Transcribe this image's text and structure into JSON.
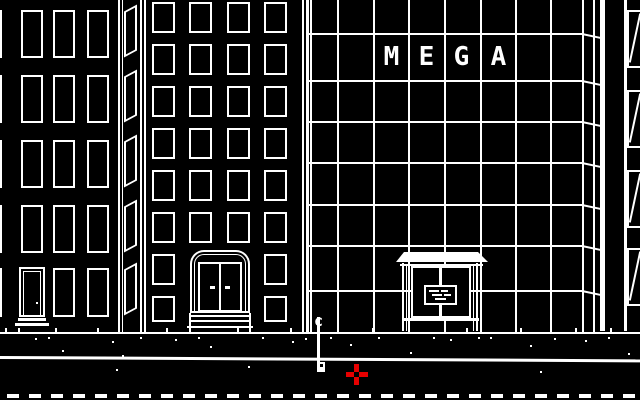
{
  "title": "1-bit city street scene",
  "colors": {
    "bg": "#000000",
    "ink": "#ffffff",
    "cursor_red": "#e60000"
  },
  "mega_sign": {
    "text": "MEGA",
    "letters": [
      "M",
      "E",
      "G",
      "A"
    ],
    "cells_x": [
      374,
      409,
      444,
      481
    ],
    "cell_w": 35,
    "y": 45,
    "h": 24
  },
  "pole": {
    "label": "c"
  },
  "cursor": {
    "x": 346,
    "y": 364
  },
  "scene": {
    "left_building": {
      "cols": [
        -20,
        21,
        53,
        87
      ],
      "col_w": 22,
      "rows": [
        10,
        75,
        140,
        205,
        268
      ],
      "row_h": 48,
      "door_col": 1,
      "door_row": 4
    },
    "left_side_face": {
      "x": 124,
      "w": 13,
      "rows": [
        8,
        73,
        138,
        203,
        266
      ],
      "h": 46
    },
    "mid_building": {
      "cols": [
        152,
        189,
        227,
        264
      ],
      "col_w": 23,
      "rows": [
        2,
        44,
        86,
        128,
        170,
        212,
        254,
        296
      ],
      "row_h": 31,
      "last_row_h": 26,
      "door_skip_rows": [
        6,
        7
      ],
      "door_skip_cols": [
        1,
        2
      ]
    },
    "mega_building": {
      "left": 306,
      "right": 582,
      "verticals": [
        310,
        337,
        373,
        408,
        444,
        480,
        515,
        550,
        582,
        593
      ],
      "vert_h": 332,
      "horizontals": [
        33,
        80,
        121,
        162,
        204,
        245,
        290
      ],
      "slant_x": 582,
      "slant_w": 19
    },
    "right_building": {
      "win_x": 627,
      "win_w": 16,
      "rows": [
        10,
        90,
        170,
        248
      ],
      "win_h": 58
    },
    "ground_y": 332,
    "curb_y": 356,
    "dashes": {
      "y": 394,
      "h": 4,
      "w": 12,
      "gap": 10,
      "offset": 7,
      "count": 30
    },
    "ticks_x": [
      5,
      18,
      55,
      97,
      166,
      237,
      290,
      372,
      466,
      520,
      575,
      610
    ],
    "speckles": [
      [
        35,
        338
      ],
      [
        48,
        337
      ],
      [
        62,
        350
      ],
      [
        112,
        341
      ],
      [
        122,
        355
      ],
      [
        140,
        337
      ],
      [
        175,
        339
      ],
      [
        198,
        337
      ],
      [
        210,
        346
      ],
      [
        262,
        337
      ],
      [
        292,
        341
      ],
      [
        305,
        338
      ],
      [
        330,
        337
      ],
      [
        350,
        344
      ],
      [
        378,
        337
      ],
      [
        410,
        352
      ],
      [
        433,
        337
      ],
      [
        450,
        339
      ],
      [
        478,
        337
      ],
      [
        490,
        337
      ],
      [
        530,
        345
      ],
      [
        554,
        338
      ],
      [
        585,
        340
      ],
      [
        608,
        337
      ],
      [
        628,
        353
      ]
    ],
    "street_dots": [
      [
        116,
        369
      ],
      [
        248,
        366
      ],
      [
        540,
        371
      ]
    ]
  }
}
